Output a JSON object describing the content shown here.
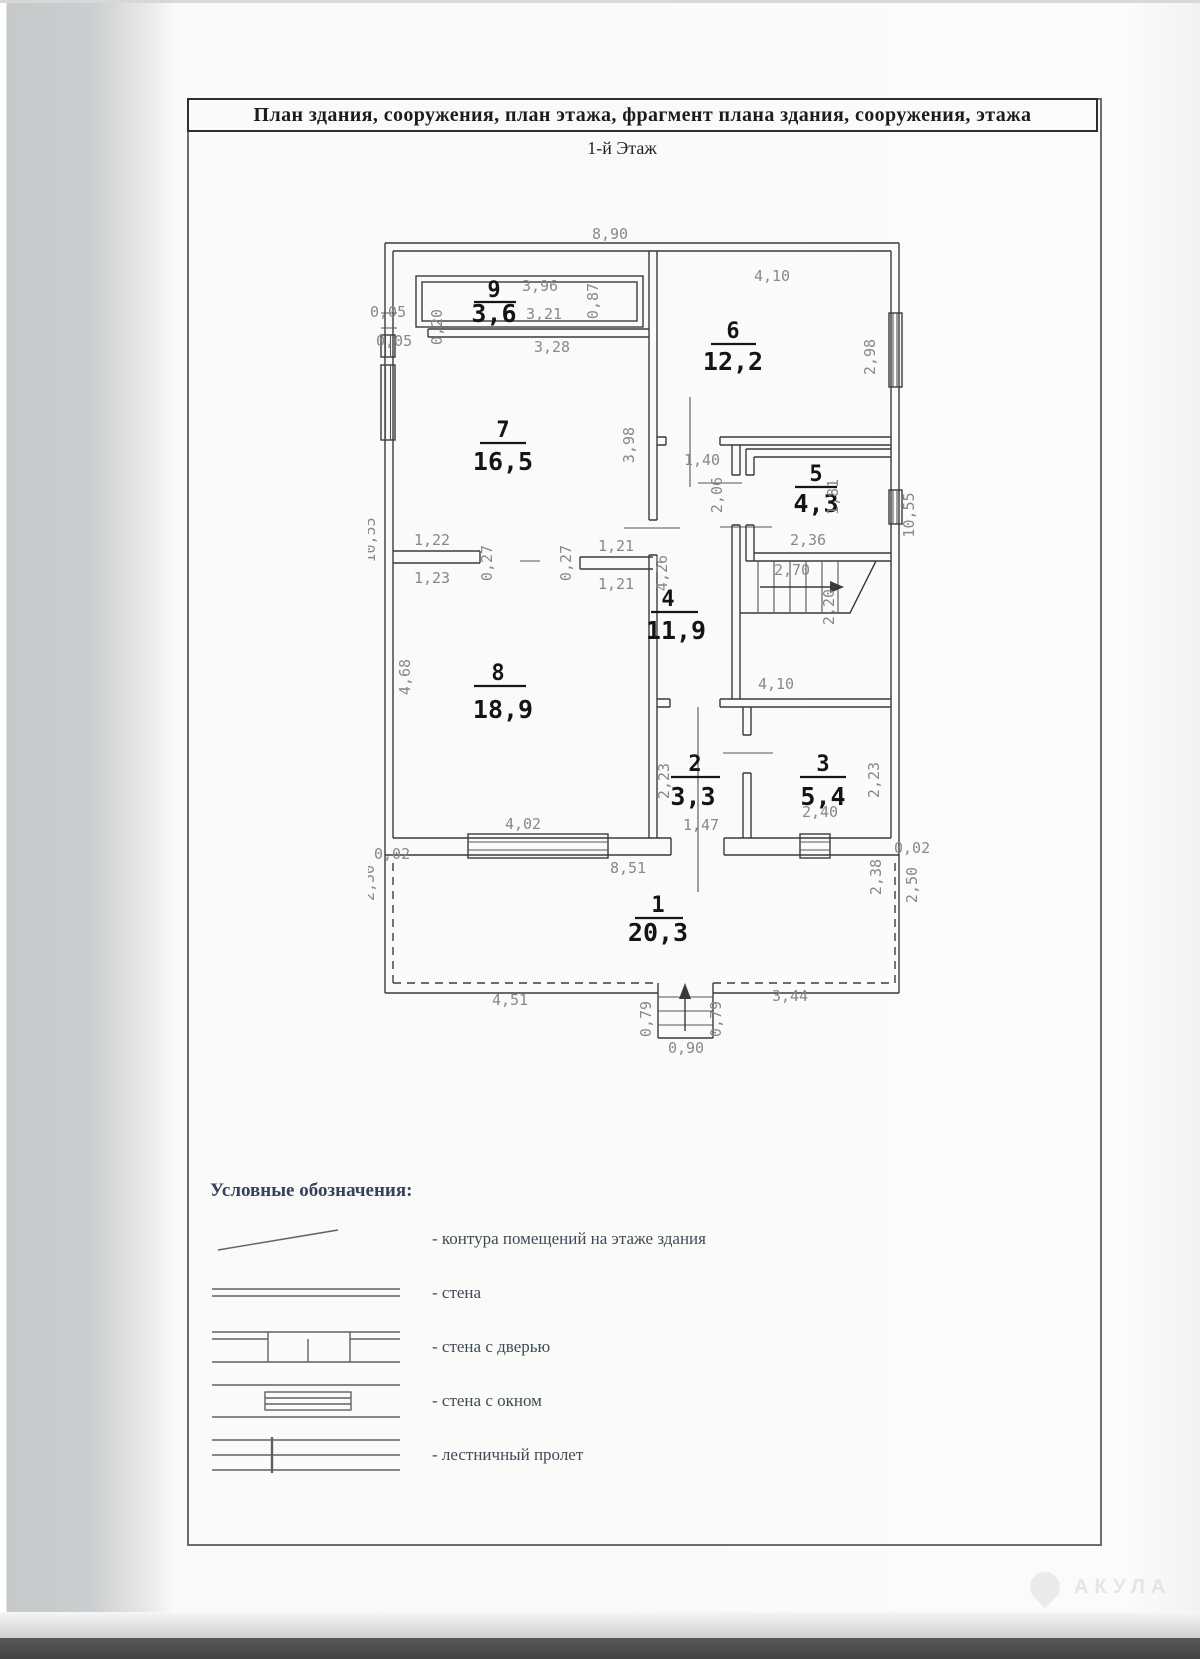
{
  "header": {
    "title": "План здания, сооружения, план этажа, фрагмент плана здания, сооружения, этажа",
    "subtitle": "1-й Этаж"
  },
  "plan": {
    "rooms": {
      "r1": {
        "number": "1",
        "area": "20,3"
      },
      "r2": {
        "number": "2",
        "area": "3,3"
      },
      "r3": {
        "number": "3",
        "area": "5,4"
      },
      "r4": {
        "number": "4",
        "area": "11,9"
      },
      "r5": {
        "number": "5",
        "area": "4,3"
      },
      "r6": {
        "number": "6",
        "area": "12,2"
      },
      "r7": {
        "number": "7",
        "area": "16,5"
      },
      "r8": {
        "number": "8",
        "area": "18,9"
      },
      "r9": {
        "number": "9",
        "area": "3,6"
      }
    },
    "dims": {
      "top_width": "8,90",
      "left_height": "10,55",
      "right_height": "10,55",
      "r9_w1": "3,96",
      "r9_w2": "3,21",
      "r9_h": "0,87",
      "corner_a": "0,05",
      "corner_b": "0,05",
      "corner_c": "0,20",
      "r6_top": "4,10",
      "r6_right": "2,98",
      "r7_top": "3,28",
      "r7_right": "3,98",
      "hall_top": "1,40",
      "hall_mid": "2,06",
      "hall_left": "4,26",
      "r5_bottom": "2,36",
      "r5_right": "1,81",
      "stairs": "2,70",
      "r4_bottom": "4,10",
      "r4_right": "2,20",
      "door78_tl": "1,22",
      "door78_bl": "1,23",
      "door78_jl": "0,27",
      "door78_jr": "0,27",
      "door78_tr": "1,21",
      "door78_br": "1,21",
      "r8_left": "4,68",
      "r8_bottom": "4,02",
      "r2_left": "2,23",
      "r2_bottom": "1,47",
      "r3_bottom": "2,40",
      "r3_right": "2,23",
      "base_left": "0,02",
      "base_right": "0,02",
      "base_width": "8,51",
      "v_left": "2,50",
      "v_right_in": "2,38",
      "v_right_out": "2,50",
      "v_bottom_l": "4,51",
      "v_bottom_r": "3,44",
      "porch_l": "0,79",
      "porch_r": "0,79",
      "porch_w": "0,90"
    }
  },
  "legend": {
    "title": "Условные обозначения:",
    "items": [
      {
        "label": "- контура помещений на этаже здания"
      },
      {
        "label": "- стена"
      },
      {
        "label": "- стена с дверью"
      },
      {
        "label": "- стена с окном"
      },
      {
        "label": "- лестничный пролет"
      }
    ]
  },
  "watermark": {
    "text": "АКУЛА"
  }
}
